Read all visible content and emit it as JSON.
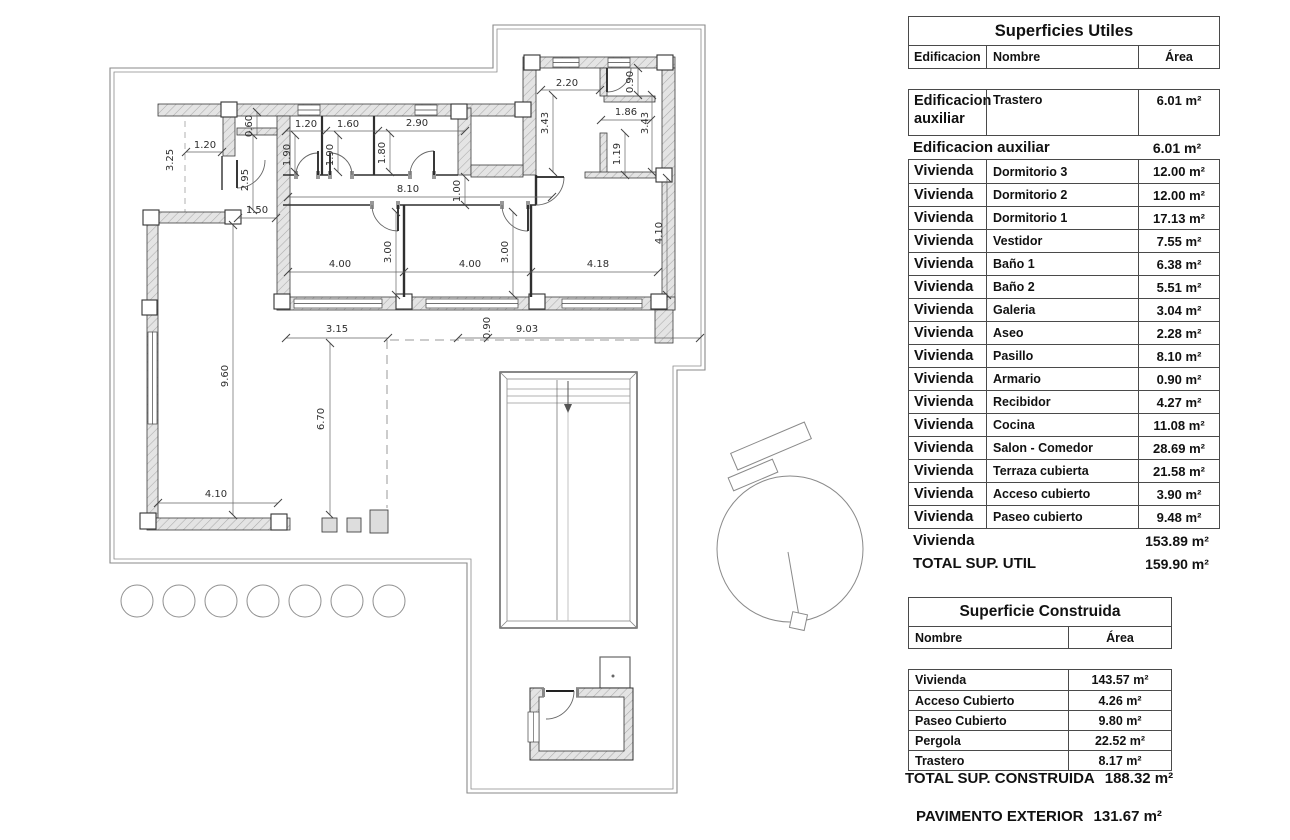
{
  "plan": {
    "dims": [
      "3.25",
      "1.20",
      "0.60",
      "2.95",
      "1.50",
      "1.20",
      "1.90",
      "1.60",
      "1.90",
      "2.90",
      "1.80",
      "8.10",
      "1.00",
      "2.20",
      "0.90",
      "3.43",
      "1.86",
      "3.43",
      "1.19",
      "4.00",
      "3.00",
      "4.00",
      "3.00",
      "4.18",
      "4.10",
      "3.15",
      "0.90",
      "9.03",
      "9.60",
      "6.70",
      "4.10",
      "4.00",
      "8.00",
      "3.00",
      "2.00"
    ]
  },
  "tables": {
    "utiles": {
      "title": "Superficies Utiles",
      "col_edificacion": "Edificacion",
      "col_nombre": "Nombre",
      "col_area": "Área",
      "aux_row": {
        "edificacion": "Edificacion auxiliar",
        "nombre": "Trastero",
        "area": "6.01 m²"
      },
      "aux_subtotal": {
        "label": "Edificacion auxiliar",
        "area": "6.01 m²"
      },
      "rows": [
        {
          "edificacion": "Vivienda",
          "nombre": "Dormitorio 3",
          "area": "12.00 m²"
        },
        {
          "edificacion": "Vivienda",
          "nombre": "Dormitorio 2",
          "area": "12.00 m²"
        },
        {
          "edificacion": "Vivienda",
          "nombre": "Dormitorio 1",
          "area": "17.13 m²"
        },
        {
          "edificacion": "Vivienda",
          "nombre": "Vestidor",
          "area": "7.55 m²"
        },
        {
          "edificacion": "Vivienda",
          "nombre": "Baño 1",
          "area": "6.38 m²"
        },
        {
          "edificacion": "Vivienda",
          "nombre": "Baño 2",
          "area": "5.51 m²"
        },
        {
          "edificacion": "Vivienda",
          "nombre": "Galeria",
          "area": "3.04 m²"
        },
        {
          "edificacion": "Vivienda",
          "nombre": "Aseo",
          "area": "2.28 m²"
        },
        {
          "edificacion": "Vivienda",
          "nombre": "Pasillo",
          "area": "8.10 m²"
        },
        {
          "edificacion": "Vivienda",
          "nombre": "Armario",
          "area": "0.90 m²"
        },
        {
          "edificacion": "Vivienda",
          "nombre": "Recibidor",
          "area": "4.27 m²"
        },
        {
          "edificacion": "Vivienda",
          "nombre": "Cocina",
          "area": "11.08 m²"
        },
        {
          "edificacion": "Vivienda",
          "nombre": "Salon - Comedor",
          "area": "28.69 m²"
        },
        {
          "edificacion": "Vivienda",
          "nombre": "Terraza cubierta",
          "area": "21.58 m²"
        },
        {
          "edificacion": "Vivienda",
          "nombre": "Acceso cubierto",
          "area": "3.90 m²"
        },
        {
          "edificacion": "Vivienda",
          "nombre": "Paseo cubierto",
          "area": "9.48 m²"
        }
      ],
      "vivienda_subtotal": {
        "label": "Vivienda",
        "area": "153.89 m²"
      },
      "total": {
        "label": "TOTAL SUP. UTIL",
        "area": "159.90 m²"
      }
    },
    "construida": {
      "title": "Superficie Construida",
      "col_nombre": "Nombre",
      "col_area": "Área",
      "rows": [
        {
          "nombre": "Vivienda",
          "area": "143.57 m²"
        },
        {
          "nombre": "Acceso Cubierto",
          "area": "4.26 m²"
        },
        {
          "nombre": "Paseo Cubierto",
          "area": "9.80 m²"
        },
        {
          "nombre": "Pergola",
          "area": "22.52 m²"
        },
        {
          "nombre": "Trastero",
          "area": "8.17 m²"
        }
      ],
      "total": {
        "label": "TOTAL SUP. CONSTRUIDA",
        "area": "188.32 m²"
      },
      "pavimento": {
        "label": "PAVIMENTO EXTERIOR",
        "area": "131.67 m²"
      }
    }
  }
}
